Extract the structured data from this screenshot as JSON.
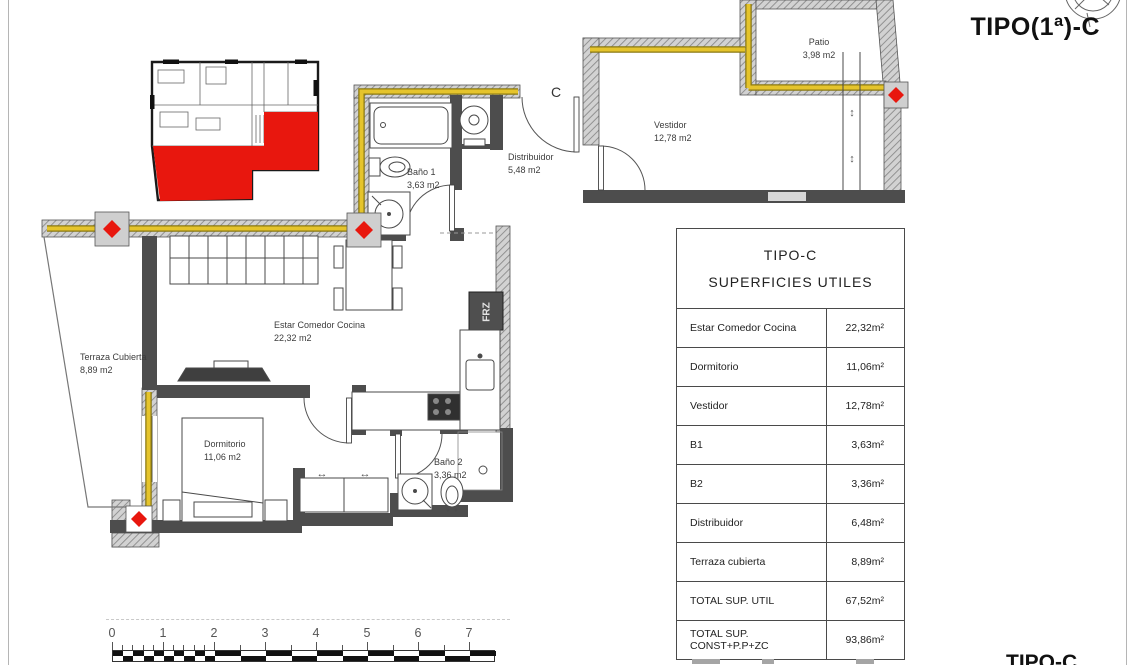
{
  "page": {
    "title": "TIPO(1ª)-C",
    "corner_label": "TIPO-C"
  },
  "plan": {
    "section_label": "C",
    "frz_label": "FRZ",
    "rooms": [
      {
        "name": "Patio",
        "area": "3,98 m2"
      },
      {
        "name": "Vestidor",
        "area": "12,78 m2"
      },
      {
        "name": "Distribuidor",
        "area": "5,48 m2"
      },
      {
        "name": "Baño 1",
        "area": "3,63 m2"
      },
      {
        "name": "Terraza Cubierta",
        "area": "8,89 m2"
      },
      {
        "name": "Estar Comedor Cocina",
        "area": "22,32 m2"
      },
      {
        "name": "Dormitorio",
        "area": "11,06 m2"
      },
      {
        "name": "Baño 2",
        "area": "3,36 m2"
      }
    ],
    "icons": {
      "slide_h": "↔",
      "slide_v": "↕"
    }
  },
  "table": {
    "title_line1": "TIPO-C",
    "title_line2": "SUPERFICIES UTILES",
    "rows": [
      {
        "label": "Estar Comedor Cocina",
        "value": "22,32m²"
      },
      {
        "label": "Dormitorio",
        "value": "11,06m²"
      },
      {
        "label": "Vestidor",
        "value": "12,78m²"
      },
      {
        "label": "B1",
        "value": "3,63m²"
      },
      {
        "label": "B2",
        "value": "3,36m²"
      },
      {
        "label": "Distribuidor",
        "value": "6,48m²"
      },
      {
        "label": "Terraza cubierta",
        "value": "8,89m²"
      },
      {
        "label": "TOTAL SUP. UTIL",
        "value": "67,52m²"
      },
      {
        "label": "TOTAL SUP. CONST+P.P+ZC",
        "value": "93,86m²"
      }
    ]
  },
  "scale_bar": {
    "ticks": [
      "0",
      "1",
      "2",
      "3",
      "4",
      "5",
      "6",
      "7"
    ]
  },
  "colors": {
    "highlight": "#e8170e",
    "conduit": "#e5c42c",
    "wall_dark": "#4d4d4d"
  }
}
